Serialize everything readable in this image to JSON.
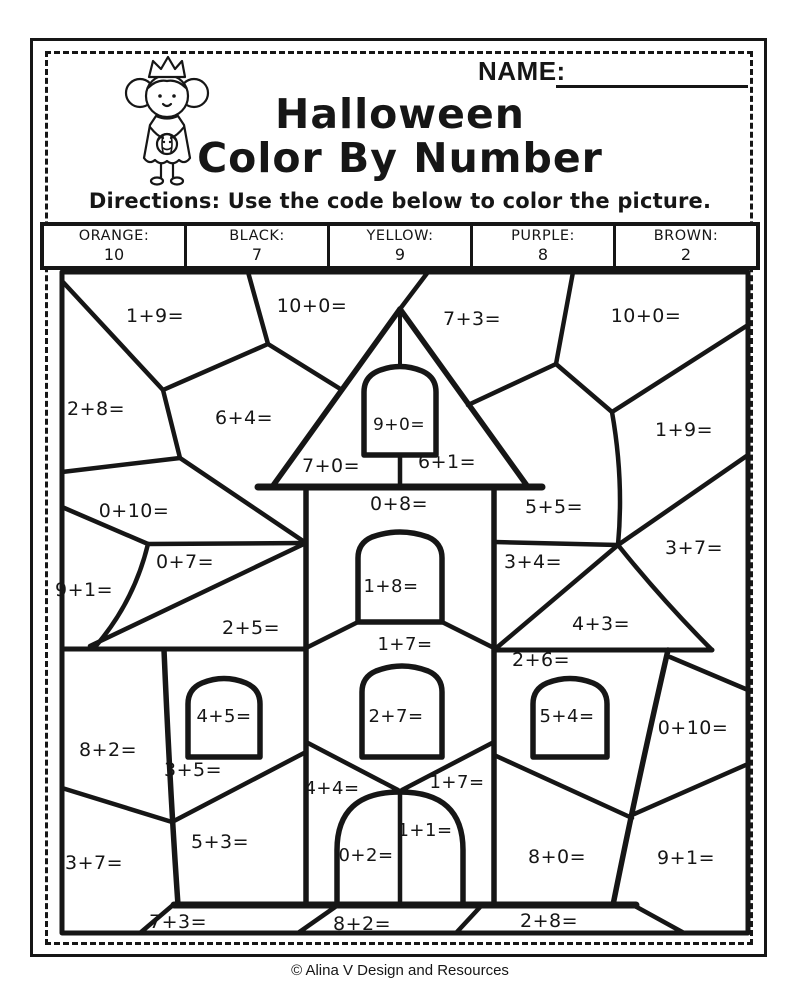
{
  "page": {
    "name_label": "NAME:",
    "title_line1": "Halloween",
    "title_line2": "Color By Number",
    "directions": "Directions: Use the code below to color the picture.",
    "footer": "© Alina V Design and Resources"
  },
  "colors": {
    "ink": "#161616",
    "paper": "#ffffff"
  },
  "color_code": {
    "columns": [
      {
        "color": "ORANGE:",
        "value": "10"
      },
      {
        "color": "BLACK:",
        "value": "7"
      },
      {
        "color": "YELLOW:",
        "value": "9"
      },
      {
        "color": "PURPLE:",
        "value": "8"
      },
      {
        "color": "BROWN:",
        "value": "2"
      }
    ]
  },
  "picture": {
    "description": "haunted-house color-by-number puzzle",
    "regions": [
      {
        "label": "1+9=",
        "x": 155,
        "y": 322
      },
      {
        "label": "10+0=",
        "x": 312,
        "y": 312
      },
      {
        "label": "7+3=",
        "x": 472,
        "y": 325
      },
      {
        "label": "10+0=",
        "x": 646,
        "y": 322
      },
      {
        "label": "2+8=",
        "x": 96,
        "y": 415
      },
      {
        "label": "6+4=",
        "x": 244,
        "y": 424
      },
      {
        "label": "9+0=",
        "x": 399,
        "y": 430,
        "fs": 17
      },
      {
        "label": "1+9=",
        "x": 684,
        "y": 436
      },
      {
        "label": "7+0=",
        "x": 331,
        "y": 472
      },
      {
        "label": "6+1=",
        "x": 447,
        "y": 468
      },
      {
        "label": "0+10=",
        "x": 134,
        "y": 517
      },
      {
        "label": "0+8=",
        "x": 399,
        "y": 510
      },
      {
        "label": "5+5=",
        "x": 554,
        "y": 513
      },
      {
        "label": "3+7=",
        "x": 694,
        "y": 554
      },
      {
        "label": "0+7=",
        "x": 185,
        "y": 568
      },
      {
        "label": "3+4=",
        "x": 533,
        "y": 568
      },
      {
        "label": "1+8=",
        "x": 391,
        "y": 592,
        "fs": 18
      },
      {
        "label": "9+1=",
        "x": 84,
        "y": 596
      },
      {
        "label": "2+5=",
        "x": 251,
        "y": 634
      },
      {
        "label": "4+3=",
        "x": 601,
        "y": 630
      },
      {
        "label": "1+7=",
        "x": 405,
        "y": 650,
        "fs": 18
      },
      {
        "label": "2+6=",
        "x": 541,
        "y": 666
      },
      {
        "label": "4+5=",
        "x": 224,
        "y": 722,
        "fs": 18
      },
      {
        "label": "2+7=",
        "x": 396,
        "y": 722,
        "fs": 18
      },
      {
        "label": "5+4=",
        "x": 567,
        "y": 722,
        "fs": 18
      },
      {
        "label": "0+10=",
        "x": 693,
        "y": 734
      },
      {
        "label": "8+2=",
        "x": 108,
        "y": 756
      },
      {
        "label": "3+5=",
        "x": 193,
        "y": 776
      },
      {
        "label": "4+4=",
        "x": 332,
        "y": 794,
        "fs": 18
      },
      {
        "label": "1+7=",
        "x": 457,
        "y": 788,
        "fs": 18
      },
      {
        "label": "1+1=",
        "x": 425,
        "y": 836,
        "fs": 18
      },
      {
        "label": "5+3=",
        "x": 220,
        "y": 848
      },
      {
        "label": "0+2=",
        "x": 366,
        "y": 861,
        "fs": 18
      },
      {
        "label": "8+0=",
        "x": 557,
        "y": 863
      },
      {
        "label": "3+7=",
        "x": 94,
        "y": 869
      },
      {
        "label": "9+1=",
        "x": 686,
        "y": 864
      },
      {
        "label": "7+3=",
        "x": 178,
        "y": 928
      },
      {
        "label": "8+2=",
        "x": 362,
        "y": 930
      },
      {
        "label": "2+8=",
        "x": 549,
        "y": 927
      }
    ]
  }
}
